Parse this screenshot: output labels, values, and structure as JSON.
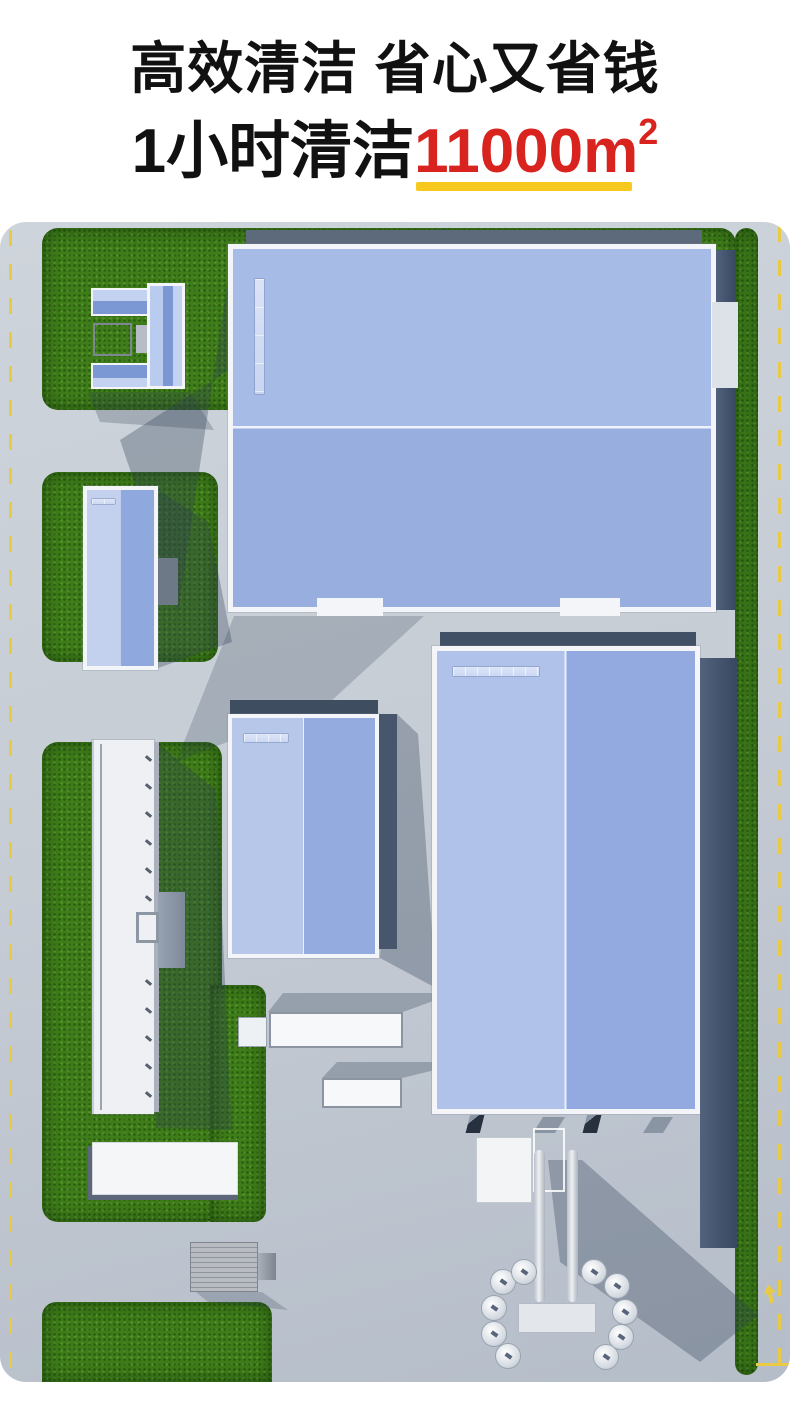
{
  "header": {
    "line1": "高效清洁 省心又省钱",
    "line2_prefix": "1小时清洁",
    "line2_highlight": "11000m",
    "line2_sup": "2"
  },
  "palette": {
    "headline_text": "#111111",
    "highlight_red": "#d8231f",
    "underline_yellow": "#f7c81d",
    "road_gray": "#c6ccd4",
    "grass_green": "#3e7d19",
    "roof_blue": "#92aadf",
    "roof_blue_light": "#b3c5ea",
    "skylight_blue": "#ccd8f2",
    "frame_white": "#f3f5f8",
    "wall_dark": "#42536b",
    "marking_yellow": "#e8ca45"
  },
  "scene": {
    "roofs": {
      "warehouse-top": {
        "rows": 2,
        "cols": 9,
        "orientation": "vertical"
      },
      "warehouse-right": {
        "rows": 9,
        "cols": 2,
        "orientation": "horizontal"
      },
      "workshop-center": {
        "rows": 5,
        "cols": 2,
        "orientation": "horizontal"
      },
      "workshop-left": {
        "rows": 8,
        "cols": 2,
        "orientation": "horizontal"
      }
    }
  }
}
